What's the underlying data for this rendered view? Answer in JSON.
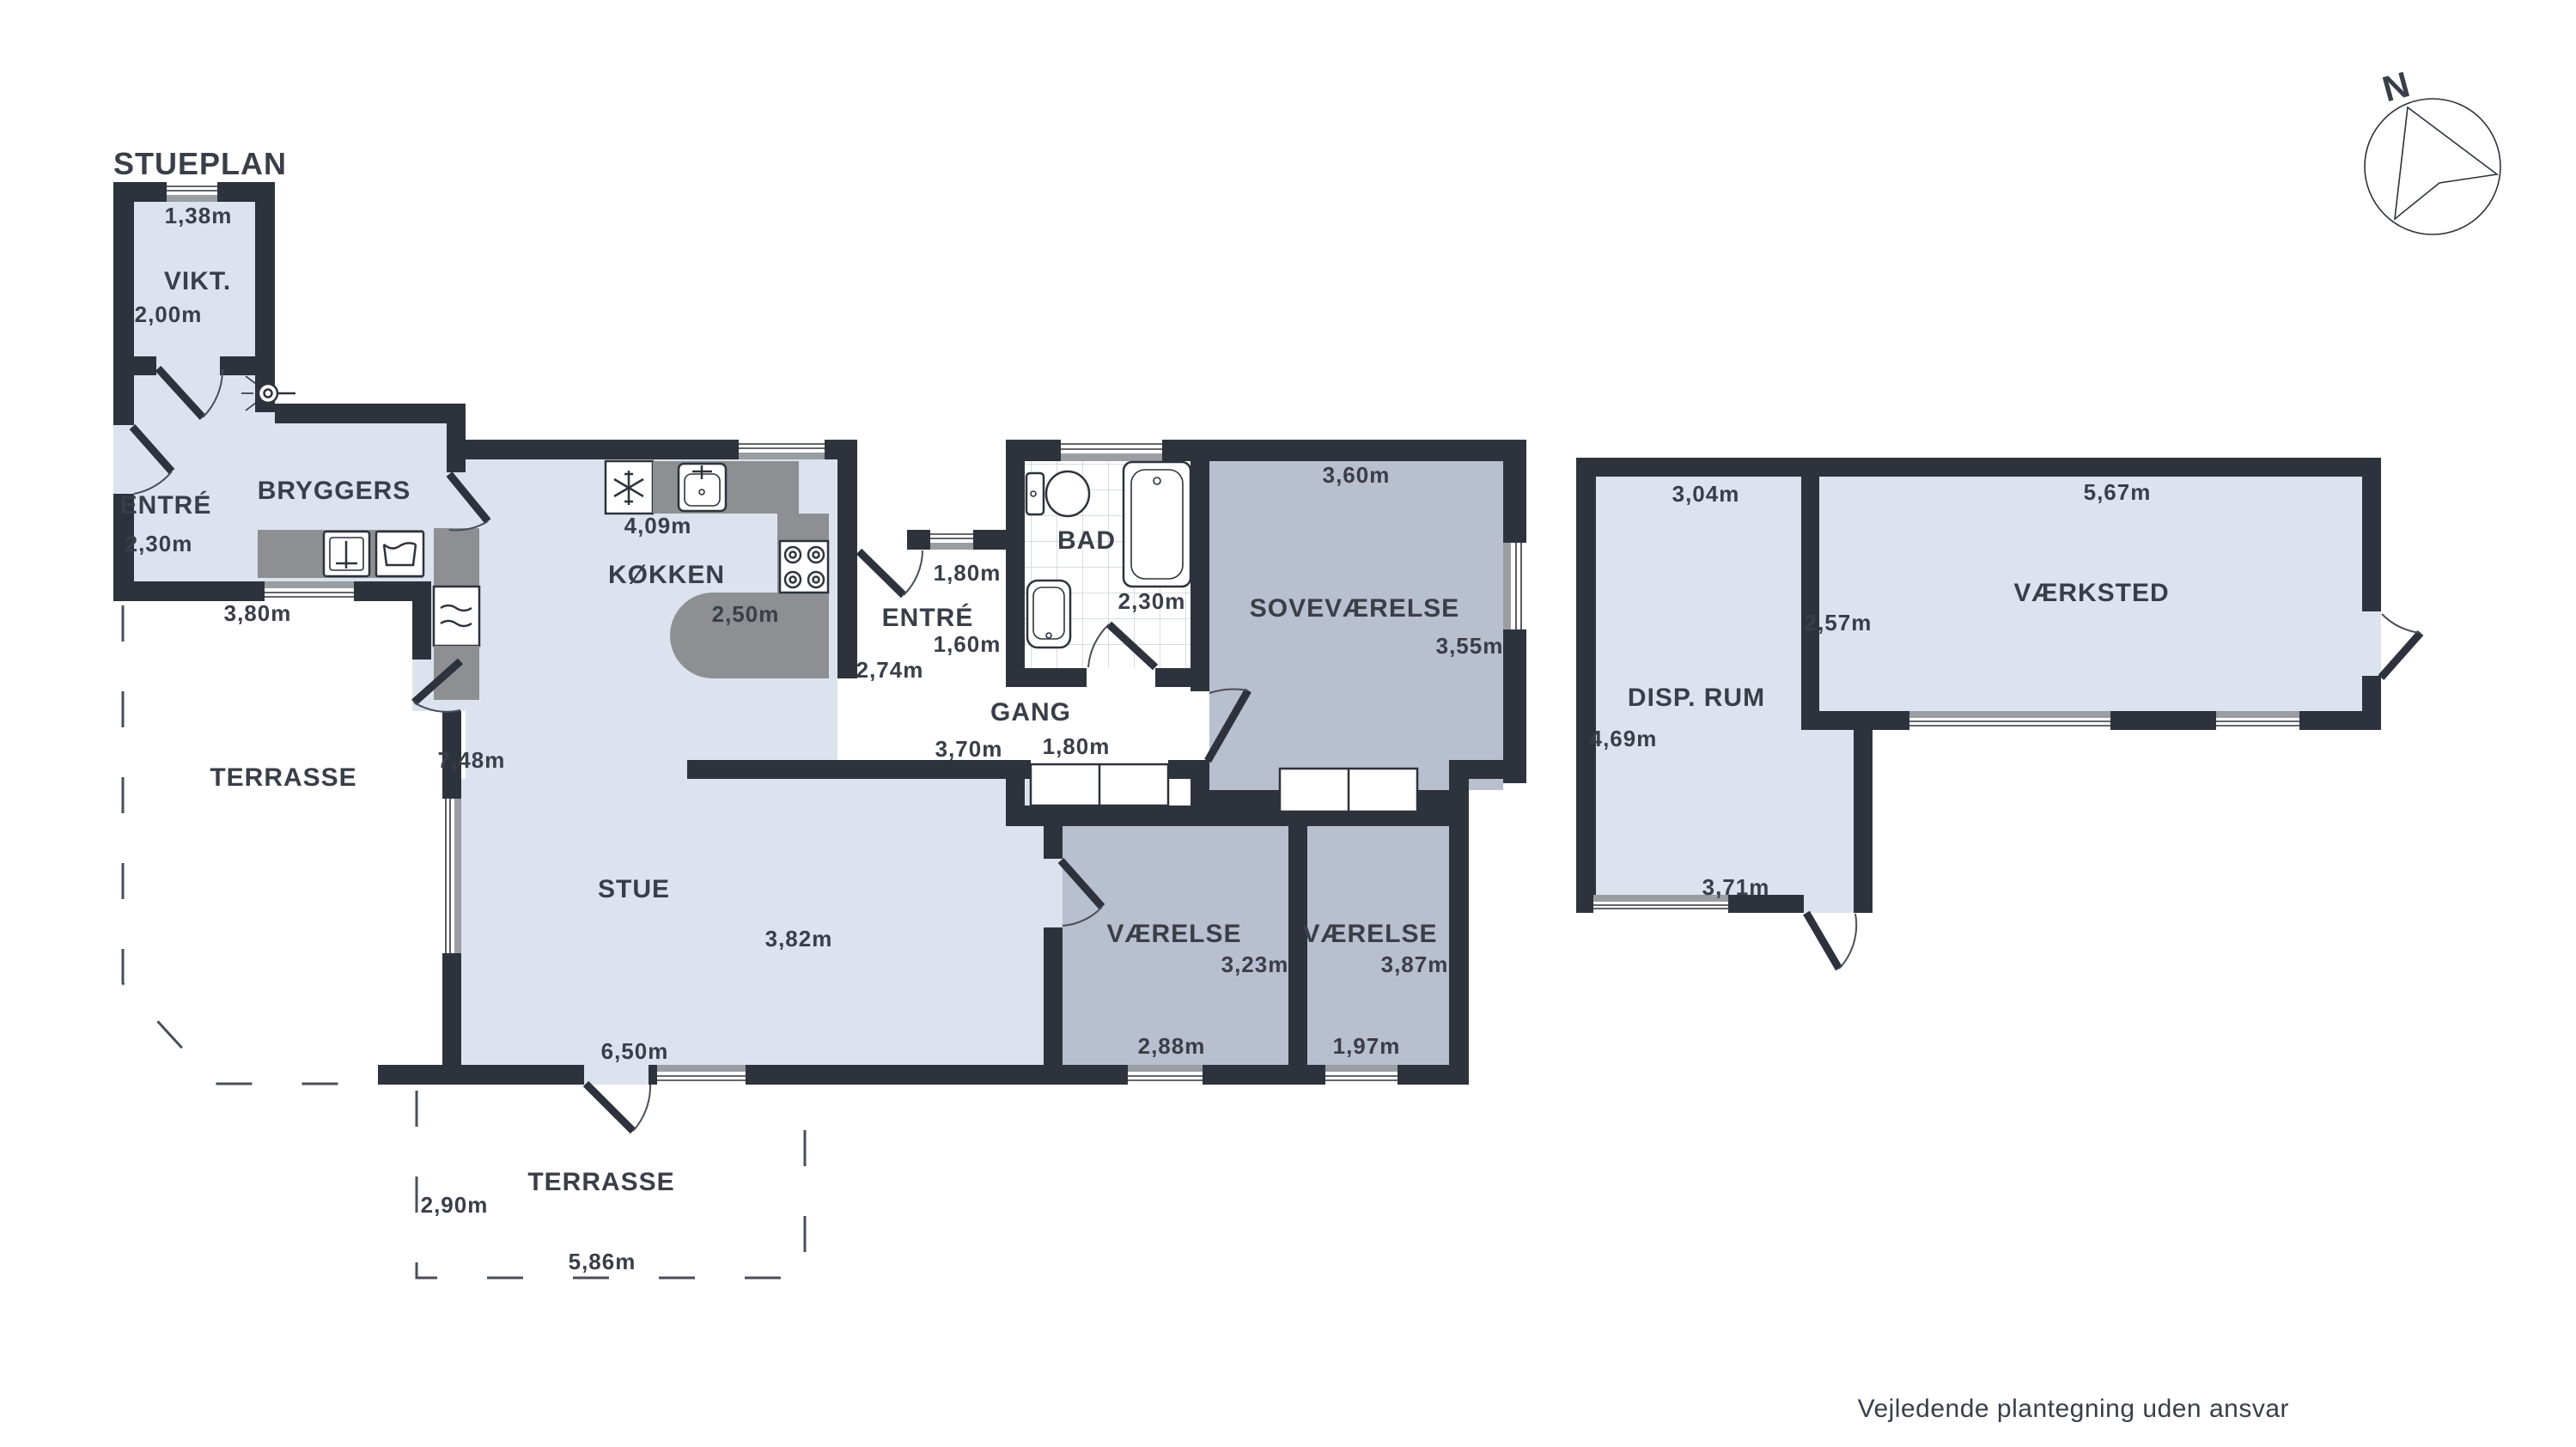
{
  "title": "STUEPLAN",
  "footer": "Vejledende plantegning uden ansvar",
  "compass": {
    "north": "N"
  },
  "colors": {
    "wall": "#2e323c",
    "room-light": "#dce3ee",
    "room-dark": "#b8bfce",
    "counter": "#8d8f92",
    "win-gray": "#9a9da1",
    "ink": "#3a3e48"
  },
  "rooms": {
    "vikt": "VIKT.",
    "entre1": "ENTRÉ",
    "bryggers": "BRYGGERS",
    "kokken": "KØKKEN",
    "entre2": "ENTRÉ",
    "bad": "BAD",
    "gang": "GANG",
    "sovevaerelse": "SOVEVÆRELSE",
    "stue": "STUE",
    "vaerelse1": "VÆRELSE",
    "vaerelse2": "VÆRELSE",
    "terrasse_left": "TERRASSE",
    "terrasse_bottom": "TERRASSE",
    "disprum": "DISP. RUM",
    "vaerksted": "VÆRKSTED"
  },
  "dimensions": {
    "vikt_w": "1,38m",
    "vikt_h": "2,00m",
    "entre1_h": "2,30m",
    "bryggers_w": "3,80m",
    "kokken_w": "4,09m",
    "kokken_h": "2,50m",
    "entre2_w": "1,80m",
    "entre2_h": "1,60m",
    "entre2_d": "2,74m",
    "bad_w": "2,30m",
    "sove_w": "3,60m",
    "sove_h": "3,55m",
    "gang_w": "3,70m",
    "gang_d": "1,80m",
    "stue_h": "7,48m",
    "stue_r": "3,82m",
    "stue_w": "6,50m",
    "vaerelse1_h": "3,23m",
    "vaerelse1_w": "2,88m",
    "vaerelse2_h": "3,87m",
    "vaerelse2_w": "1,97m",
    "terrasse_h": "2,90m",
    "terrasse_w": "5,86m",
    "disprum_w": "3,04m",
    "disprum_h": "4,69m",
    "disprum_w2": "3,71m",
    "vaerksted_w": "5,67m",
    "vaerksted_h": "2,57m"
  },
  "icons": {
    "compass": "compass-north-icon",
    "toilet": "toilet-icon",
    "bathtub": "bathtub-icon",
    "bad_sink": "washbasin-icon",
    "kitchen_sink": "kitchen-sink-icon",
    "bryggers_sink": "utility-sink-icon",
    "laundry_tub": "laundry-tub-icon",
    "washer": "washing-machine-icon",
    "fridge": "fridge-snowflake-icon",
    "stove": "stove-burners-icon",
    "lamp": "wall-lamp-icon"
  }
}
